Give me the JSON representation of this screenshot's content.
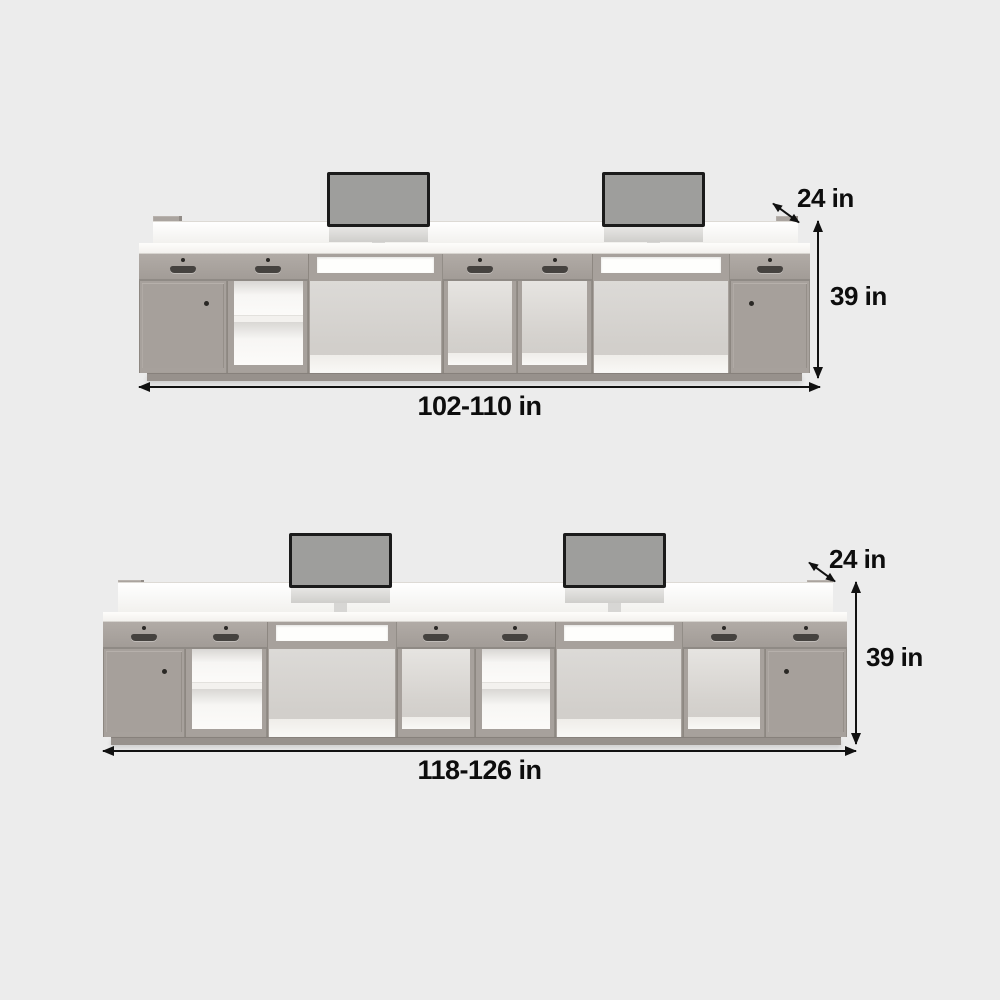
{
  "page": {
    "background_color": "#ececec"
  },
  "desks": [
    {
      "name": "desk-top",
      "labels": {
        "depth": "24 in",
        "height": "39 in",
        "width": "102-110 in"
      },
      "monitor_count": 2,
      "sections": [
        "cabinet-door",
        "drawer-open-shelf",
        "knee-space",
        "drawer-open-cabinet",
        "drawer-open-cabinet",
        "knee-space",
        "cabinet-door"
      ]
    },
    {
      "name": "desk-bottom",
      "labels": {
        "depth": "24 in",
        "height": "39 in",
        "width": "118-126 in"
      },
      "monitor_count": 2,
      "sections": [
        "cabinet-door",
        "drawer-open-shelf",
        "knee-space",
        "drawer-open-cabinet",
        "drawer-open-shelf",
        "knee-space",
        "drawer-open-cabinet",
        "cabinet-door"
      ]
    }
  ],
  "colors": {
    "furniture_gray": "#a7a19c",
    "surface_white": "#faf9f7",
    "annotation_text": "#111111",
    "monitor_screen": "#9e9e9c",
    "monitor_frame": "#1b1b1b"
  }
}
